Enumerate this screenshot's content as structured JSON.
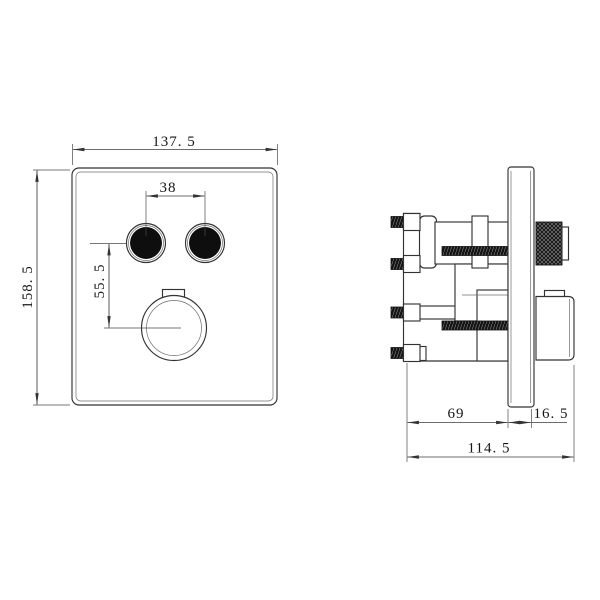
{
  "drawing": {
    "type": "technical-dimension-drawing",
    "front_view": {
      "labels": {
        "plate_width": "137. 5",
        "plate_height": "158. 5",
        "button_spacing": "38",
        "knob_offset": "55. 5"
      }
    },
    "side_view": {
      "labels": {
        "body_depth": "69",
        "plate_section": "16. 5",
        "total_depth": "114. 5"
      }
    },
    "colors": {
      "background": "#ffffff",
      "line": "#333333",
      "dimension_line": "#3c3c3c",
      "fill_dark": "#0e0e0e",
      "text": "#161616"
    }
  }
}
